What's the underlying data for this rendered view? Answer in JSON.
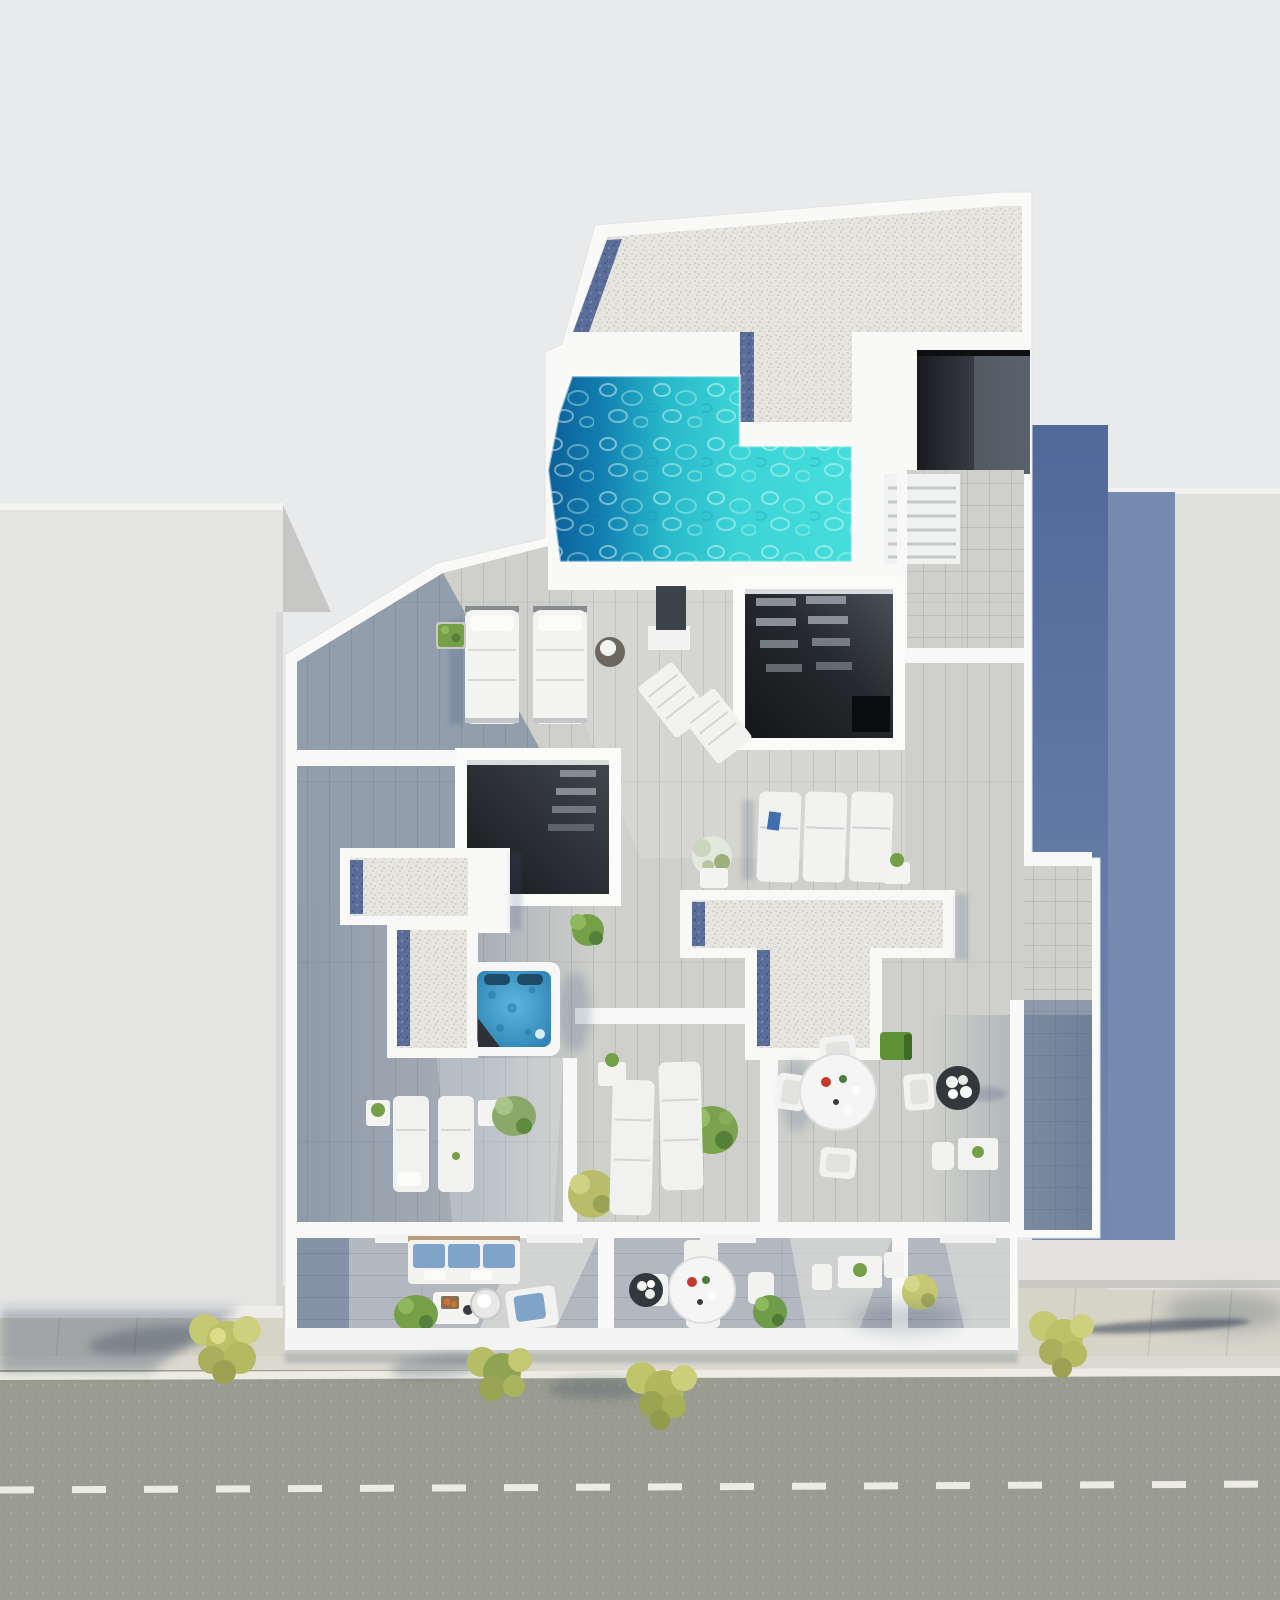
{
  "scene": {
    "description": "Aerial top-down 3D architectural render of a penthouse rooftop terrace with swimming pool and hot tub, flanked by neighboring buildings, with balconies, sidewalk and street at the bottom",
    "view": "top-down"
  },
  "colors": {
    "background": "#e9eaec",
    "left_building": "#e4e4e2",
    "left_building_face": "#c7c7c5",
    "right_building": "#e0e0de",
    "right_building_low": "#e2e1df",
    "building_white": "#f9f9f8",
    "deck": "#cfd0cb",
    "deck_balcony": "#b2b7c0",
    "gravel": "#e7e5e0",
    "gravel_blue": "#5a6e99",
    "pool_deep": "#0c5f97",
    "pool_mid": "#27b7c9",
    "pool_shallow": "#45dedc",
    "jacuzzi_center": "#5cb6de",
    "jacuzzi_edge": "#2f84b4",
    "void_dark": "#141619",
    "void_light": "#4b5258",
    "street": "#9a9c90",
    "sidewalk": "#d6d3c7",
    "curb": "#dcd9d0",
    "road_line": "#edece4",
    "shadow_alley": "#51699a",
    "shadow_alley_light": "#7289ae",
    "shadow_wedge": "#6a82aa",
    "shadow_deck": "#3f5880",
    "tree_yellow": "#c6c973",
    "tree_yellow_dark": "#a9af5c",
    "tree_green": "#8fa354",
    "plant_green": "#76a047",
    "plant_green_dark": "#55803a",
    "grass": "#5f9137",
    "sofa_blue": "#7fa3c9",
    "accent_red": "#c43b2e",
    "accent_orange": "#d4702e",
    "planter_dark": "#33383c",
    "shower_dark": "#3c4249",
    "white_furniture": "#f2f3f1"
  },
  "inventory": {
    "swimming_pool": 1,
    "hot_tub": 1,
    "padded_sunbeds": 2,
    "sun_loungers": 7,
    "folding_deck_chairs": 2,
    "round_dining_tables": 2,
    "dining_chairs": 8,
    "small_side_tables": 7,
    "sofa": 1,
    "armchair": 1,
    "coffee_table": 1,
    "skylight_openings": 2,
    "staircases": 2,
    "gravel_roof_sections": 3,
    "balconies": 3,
    "street_trees": 4,
    "flower_planters": 2,
    "green_plants": 10,
    "outdoor_shower": 1
  },
  "street": {
    "edge_line": "solid white",
    "center_line": "dashed white"
  }
}
